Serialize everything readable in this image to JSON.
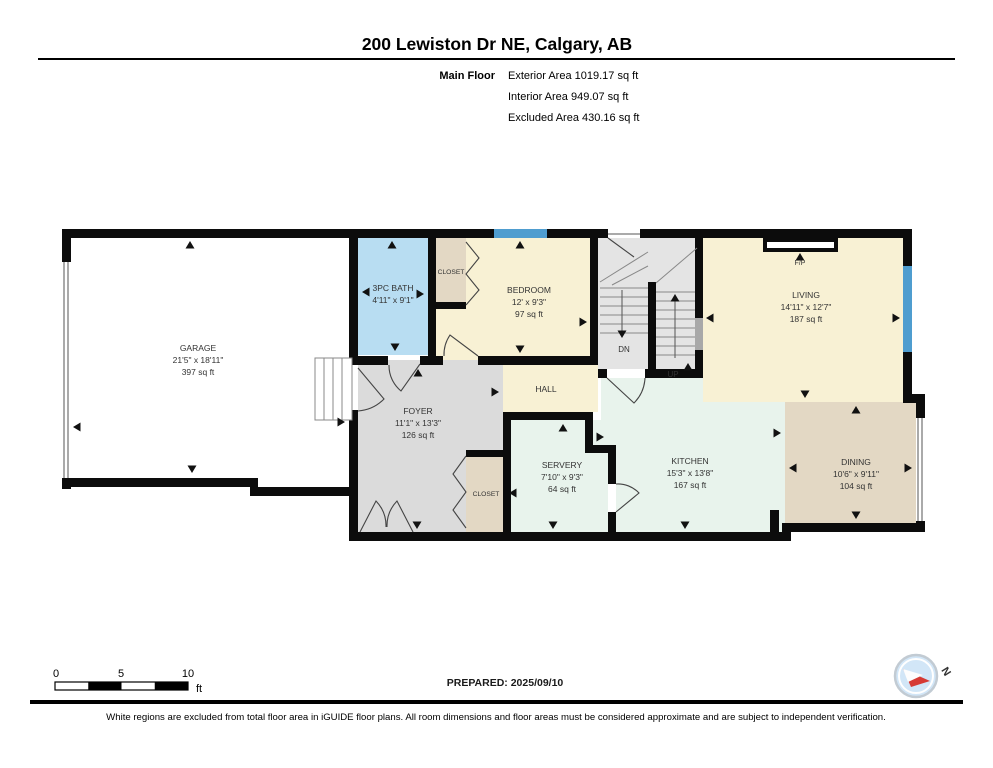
{
  "header": {
    "title": "200 Lewiston Dr NE, Calgary, AB",
    "floor_label": "Main Floor",
    "exterior_area": "Exterior Area 1019.17 sq ft",
    "interior_area": "Interior Area 949.07 sq ft",
    "excluded_area": "Excluded Area 430.16 sq ft"
  },
  "rooms": {
    "garage": {
      "name": "GARAGE",
      "dims": "21'5\" x 18'11\"",
      "area": "397 sq ft"
    },
    "bath": {
      "name": "3PC BATH",
      "dims": "4'11\" x 9'1\""
    },
    "bedroom_closet": {
      "name": "CLOSET"
    },
    "bedroom": {
      "name": "BEDROOM",
      "dims": "12' x 9'3\"",
      "area": "97 sq ft"
    },
    "living": {
      "name": "LIVING",
      "dims": "14'11\" x 12'7\"",
      "area": "187 sq ft"
    },
    "hall": {
      "name": "HALL"
    },
    "foyer": {
      "name": "FOYER",
      "dims": "11'1\" x 13'3\"",
      "area": "126 sq ft"
    },
    "foyer_closet": {
      "name": "CLOSET"
    },
    "servery": {
      "name": "SERVERY",
      "dims": "7'10\" x 9'3\"",
      "area": "64 sq ft"
    },
    "kitchen": {
      "name": "KITCHEN",
      "dims": "15'3\" x 13'8\"",
      "area": "167 sq ft"
    },
    "dining": {
      "name": "DINING",
      "dims": "10'6\" x 9'11\"",
      "area": "104 sq ft"
    }
  },
  "plan_labels": {
    "down": "DN",
    "up": "UP",
    "fireplace": "F/P"
  },
  "scale_bar": {
    "tick0": "0",
    "tick5": "5",
    "tick10": "10",
    "unit": "ft"
  },
  "footer": {
    "prepared": "PREPARED: 2025/09/10",
    "compass_north": "N",
    "disclaimer": "White regions are excluded from total floor area in iGUIDE floor plans. All room dimensions and floor areas must be considered approximate and are subject to independent verification."
  },
  "colors": {
    "wall": "#0c0c0c",
    "window_blue": "#4f9dcf",
    "bath_blue": "#b8ddf2",
    "cream": "#f8f1d4",
    "gray_room": "#dbdbdb",
    "stair_gray": "#e4e4e4",
    "kitchen_pale": "#e8f3ec",
    "tan": "#e3d8c4"
  }
}
